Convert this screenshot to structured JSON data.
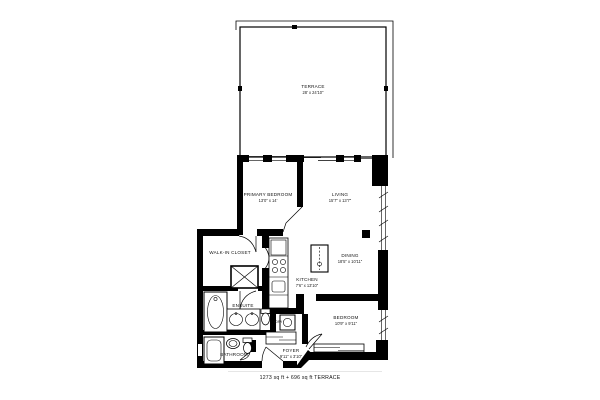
{
  "page": {
    "background_color": "#ffffff",
    "wall_color": "#000000"
  },
  "floor_plan": {
    "rooms": {
      "terrace": {
        "name": "TERRACE",
        "dims": "28' x 24'10\""
      },
      "primary_bedroom": {
        "name": "PRIMARY BEDROOM",
        "dims": "13'0\" x 14'"
      },
      "living": {
        "name": "LIVING",
        "dims": "15'7\" x 13'7\""
      },
      "dining": {
        "name": "DINING",
        "dims": "18'5\" x 10'11\""
      },
      "kitchen": {
        "name": "KITCHEN",
        "dims": "7'6\" x 13'10\""
      },
      "walk_in_closet": {
        "name": "WALK-IN CLOSET",
        "dims": ""
      },
      "ensuite": {
        "name": "ENSUITE",
        "dims": ""
      },
      "laundry": {
        "name": "LDRY",
        "dims": ""
      },
      "bathroom": {
        "name": "BATHROOM",
        "dims": ""
      },
      "foyer": {
        "name": "FOYER",
        "dims": "9'11\" x 3'10\""
      },
      "bedroom": {
        "name": "BEDROOM",
        "dims": "10'9\" x 9'11\""
      }
    },
    "footer": {
      "area_summary": "1273 sq ft + 696 sq ft TERRACE"
    }
  }
}
